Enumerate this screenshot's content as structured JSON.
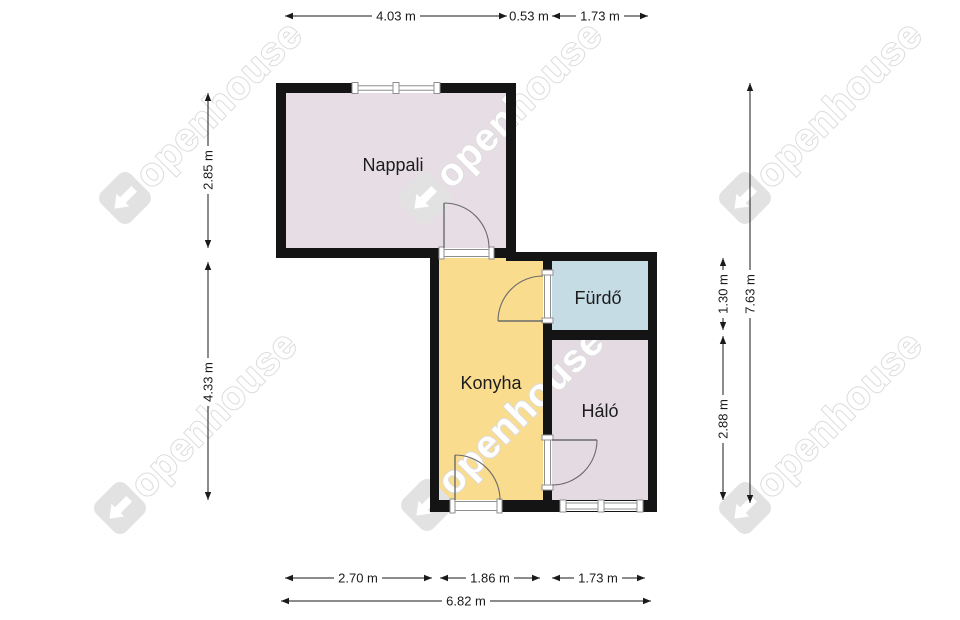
{
  "watermark": {
    "text": "openhouse"
  },
  "colors": {
    "wall": "#141414",
    "living_fill": "#e6dee4",
    "kitchen_fill": "#f9dc8d",
    "bathroom_fill": "#c5dce5",
    "bedroom_fill": "#e4dbe2",
    "watermark": "#e2e2e2",
    "dimension_text": "#1a1a1a"
  },
  "rooms": {
    "living": "Nappali",
    "bathroom": "Fürdő",
    "kitchen": "Konyha",
    "bedroom": "Háló"
  },
  "dimensions": {
    "top": [
      "4.03 m",
      "0.53 m",
      "1.73 m"
    ],
    "left": [
      "2.85 m",
      "4.33 m"
    ],
    "right": [
      "1.30 m",
      "2.88 m",
      "7.63 m"
    ],
    "bottom": [
      "2.70 m",
      "1.86 m",
      "1.73 m"
    ],
    "total_width": "6.82 m"
  }
}
